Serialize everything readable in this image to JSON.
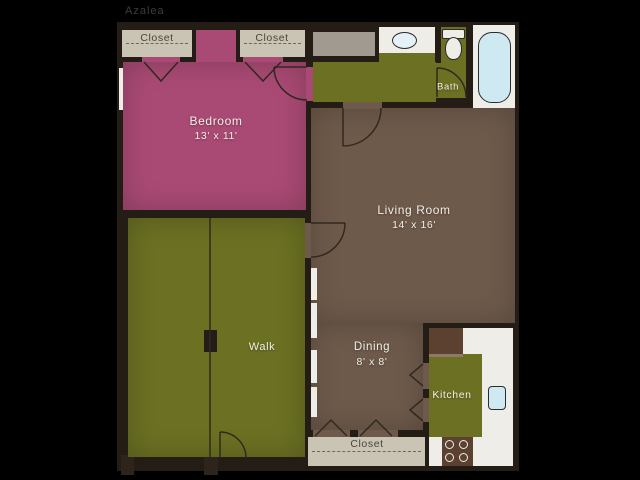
{
  "title": "Azalea",
  "rooms": {
    "bedroom": {
      "name": "Bedroom",
      "dims": "13' x 11'"
    },
    "living": {
      "name": "Living Room",
      "dims": "14' x 16'"
    },
    "dining": {
      "name": "Dining",
      "dims": "8' x 8'"
    },
    "walk": {
      "name": "Walk"
    },
    "kitchen": {
      "name": "Kitchen"
    },
    "bath": {
      "name": "Bath"
    },
    "closet_top_left": {
      "name": "Closet"
    },
    "closet_top_right": {
      "name": "Closet"
    },
    "closet_bottom": {
      "name": "Closet"
    }
  },
  "fixtures": [
    "bathtub",
    "toilet",
    "bathroom-sink",
    "kitchen-sink",
    "refrigerator",
    "stove",
    "bedroom-window",
    "sliding-doors",
    "entry-door",
    "bifold-closet-doors",
    "walk-divider"
  ],
  "colors": {
    "bg": "#000000",
    "wall": "#241d16",
    "bedroom": "#a94a74",
    "olive": "#6b7023",
    "floor": "#6e5a4b",
    "beige": "#cac4b4",
    "gray": "#a19a91",
    "white": "#efede8",
    "water": "#cfe9f3",
    "appliance": "#5d4130",
    "line": "#32281f",
    "label-light": "#f2efe7",
    "label-dark": "#4b453b",
    "title": "#3d3d3d"
  }
}
